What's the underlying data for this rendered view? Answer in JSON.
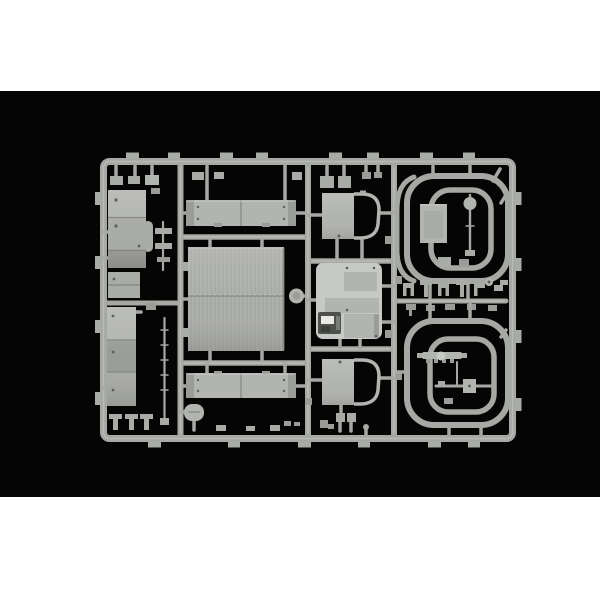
{
  "scene": {
    "type": "product-photo",
    "subject": "injection-moulded plastic model kit sprue (parts tree) of light grey styrene",
    "setting": "sprue lies centered on a black backdrop; photo has white margins top and bottom",
    "text_visible": "none"
  },
  "colors": {
    "margin": "#ffffff",
    "backdrop": "#050505",
    "runner": "#a6a8a4",
    "runner_hi": "#c9cbc7",
    "plastic": "#b2b4b0",
    "plastic_bright": "#c7c9c5",
    "plastic_mid": "#a9aba7",
    "plastic_dim": "#9a9c98",
    "plastic_dark": "#4e504c",
    "slot": "#e9e9e5",
    "seam": "#84867f",
    "dot": "#5e605c"
  },
  "parts": {
    "frame": "rectangular runner frame with gate tabs",
    "left_column": "stacked cargo-body side panels and thin rods",
    "top_cross_panel": "segmented cross panel (upper)",
    "roof_panel": "large ribbed roof panel with centre seam and round cap",
    "bottom_cross_panel": "segmented cross panel (lower)",
    "door_panel_upper": "cab side panel with window frame (upper)",
    "door_panel_lower": "cab side panel with window frame (lower)",
    "interior_cluster": "cab interior block parts on base plate",
    "grille_part": "small dark grille part with bright slot",
    "window_frame_upper": "nested curved window-frame loops (upper right)",
    "window_frame_lower": "nested curved window-frame loops (lower right)",
    "small_fittings": "rows of small brackets, clips and round fittings"
  }
}
